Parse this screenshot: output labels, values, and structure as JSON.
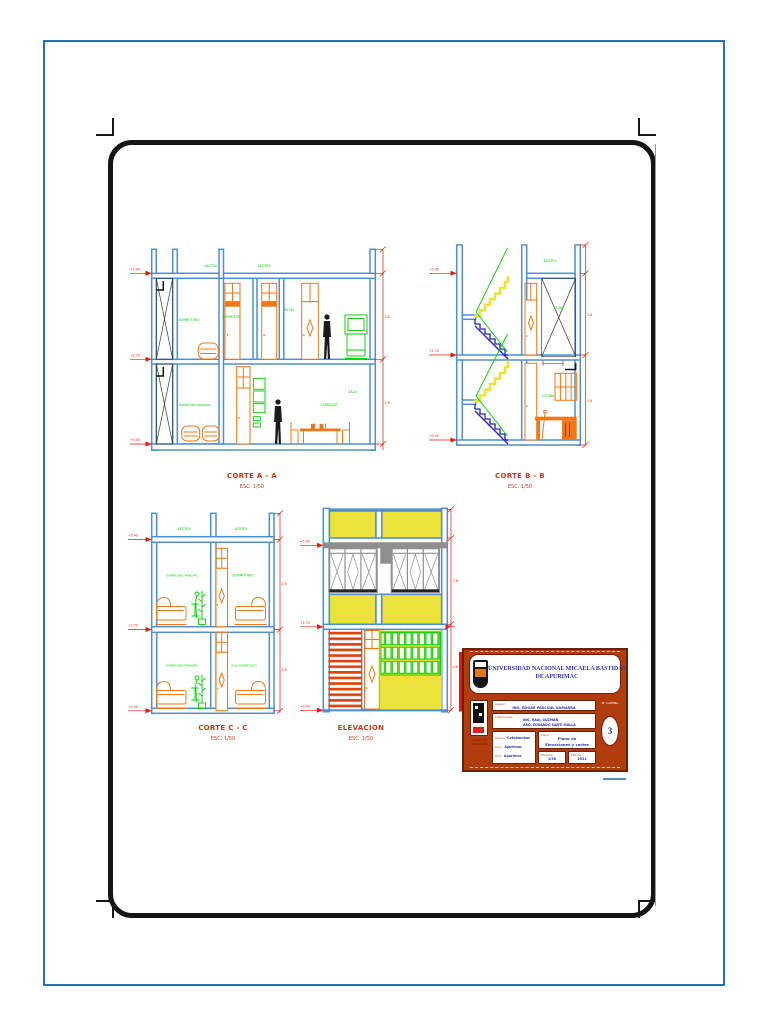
{
  "colors": {
    "cad_blue": "#4f8fd0",
    "green": "#00cc00",
    "orange": "#f07818",
    "red": "#e8180c",
    "label": "#c43a16",
    "yellow": "#ece33a",
    "navy": "#2424bb",
    "gray": "#8f8f8f",
    "block_bg": "#b13c0e",
    "block_border": "#6e2005",
    "title_blue": "#2a35b8"
  },
  "drawings": {
    "corte_a": {
      "title": "CORTE A - A",
      "scale": "ESC. 1/50",
      "roof_labels": [
        "AZOTEA",
        "AZOTEA"
      ],
      "upper_labels": [
        "DORMITORIO",
        "CORREDOR",
        "SS.HH"
      ],
      "lower_labels": [
        "DORMITORIO PRINCIPAL",
        "COMEDOR",
        "SALA"
      ],
      "levels": [
        "+5.40",
        "+2.70",
        "+0.00"
      ],
      "dims": [
        "2.6",
        "2.6"
      ]
    },
    "corte_b": {
      "title": "CORTE B - B",
      "scale": "ESC. 1/50",
      "roof_labels": [
        "AZOTEA"
      ],
      "upper_labels": [
        "SS.HH"
      ],
      "lower_labels": [
        "COCINA"
      ],
      "levels": [
        "+5.40",
        "+2.70",
        "+0.00"
      ],
      "dims": [
        "2.6",
        "2.6"
      ]
    },
    "corte_c": {
      "title": "CORTE C - C",
      "scale": "ESC. 1/50",
      "roof_labels": [
        "AZOTEA",
        "AZOTEA"
      ],
      "upper_labels": [
        "DORMITORIO PRINCIPAL",
        "DORMITORIO"
      ],
      "lower_labels": [
        "DORMITORIO PRINCIPAL",
        "SALA DORMITORIO"
      ],
      "levels": [
        "+5.40",
        "+2.70",
        "+0.00"
      ],
      "dims": [
        "2.6",
        "2.6"
      ]
    },
    "elevacion": {
      "title": "ELEVACION",
      "scale": "ESC. 1/50",
      "levels": [
        "+5.40",
        "+2.70",
        "+0.00"
      ],
      "dims": [
        "2.6",
        "2.6"
      ]
    }
  },
  "title_block": {
    "university_line1": "UNIVERSIDAD NACIONAL MICAELA BASTIDAS",
    "university_line2": "DE APURIMAC",
    "asesor_label": "Asesor:",
    "asesor_value": "ING. EDGAR PASCUAL GAMARRA",
    "integrantes_label": "Integrantes:",
    "integrante_1": "ING. RAUL GUZMAN",
    "integrante_2": "ARQ. EDUARDO SANTI MALLA",
    "ubicacion_caption": "PLANO DE UBICACION",
    "depto_label": "Depto:",
    "depto_value": "Cotabambas",
    "prov_label": "Prov:",
    "prov_value": "Apurimac",
    "dist_label": "Dist:",
    "dist_value": "Apurimac",
    "plano_label": "Plano:",
    "plano_line1": "Plano de",
    "plano_line2": "Elevaciones y cortes",
    "escala_label": "ESCALA:",
    "escala_value": "1/50",
    "fecha_label": "FECHA:",
    "fecha_value": "2021",
    "lamina_label": "N° LAMINA",
    "lamina_number": "3"
  }
}
